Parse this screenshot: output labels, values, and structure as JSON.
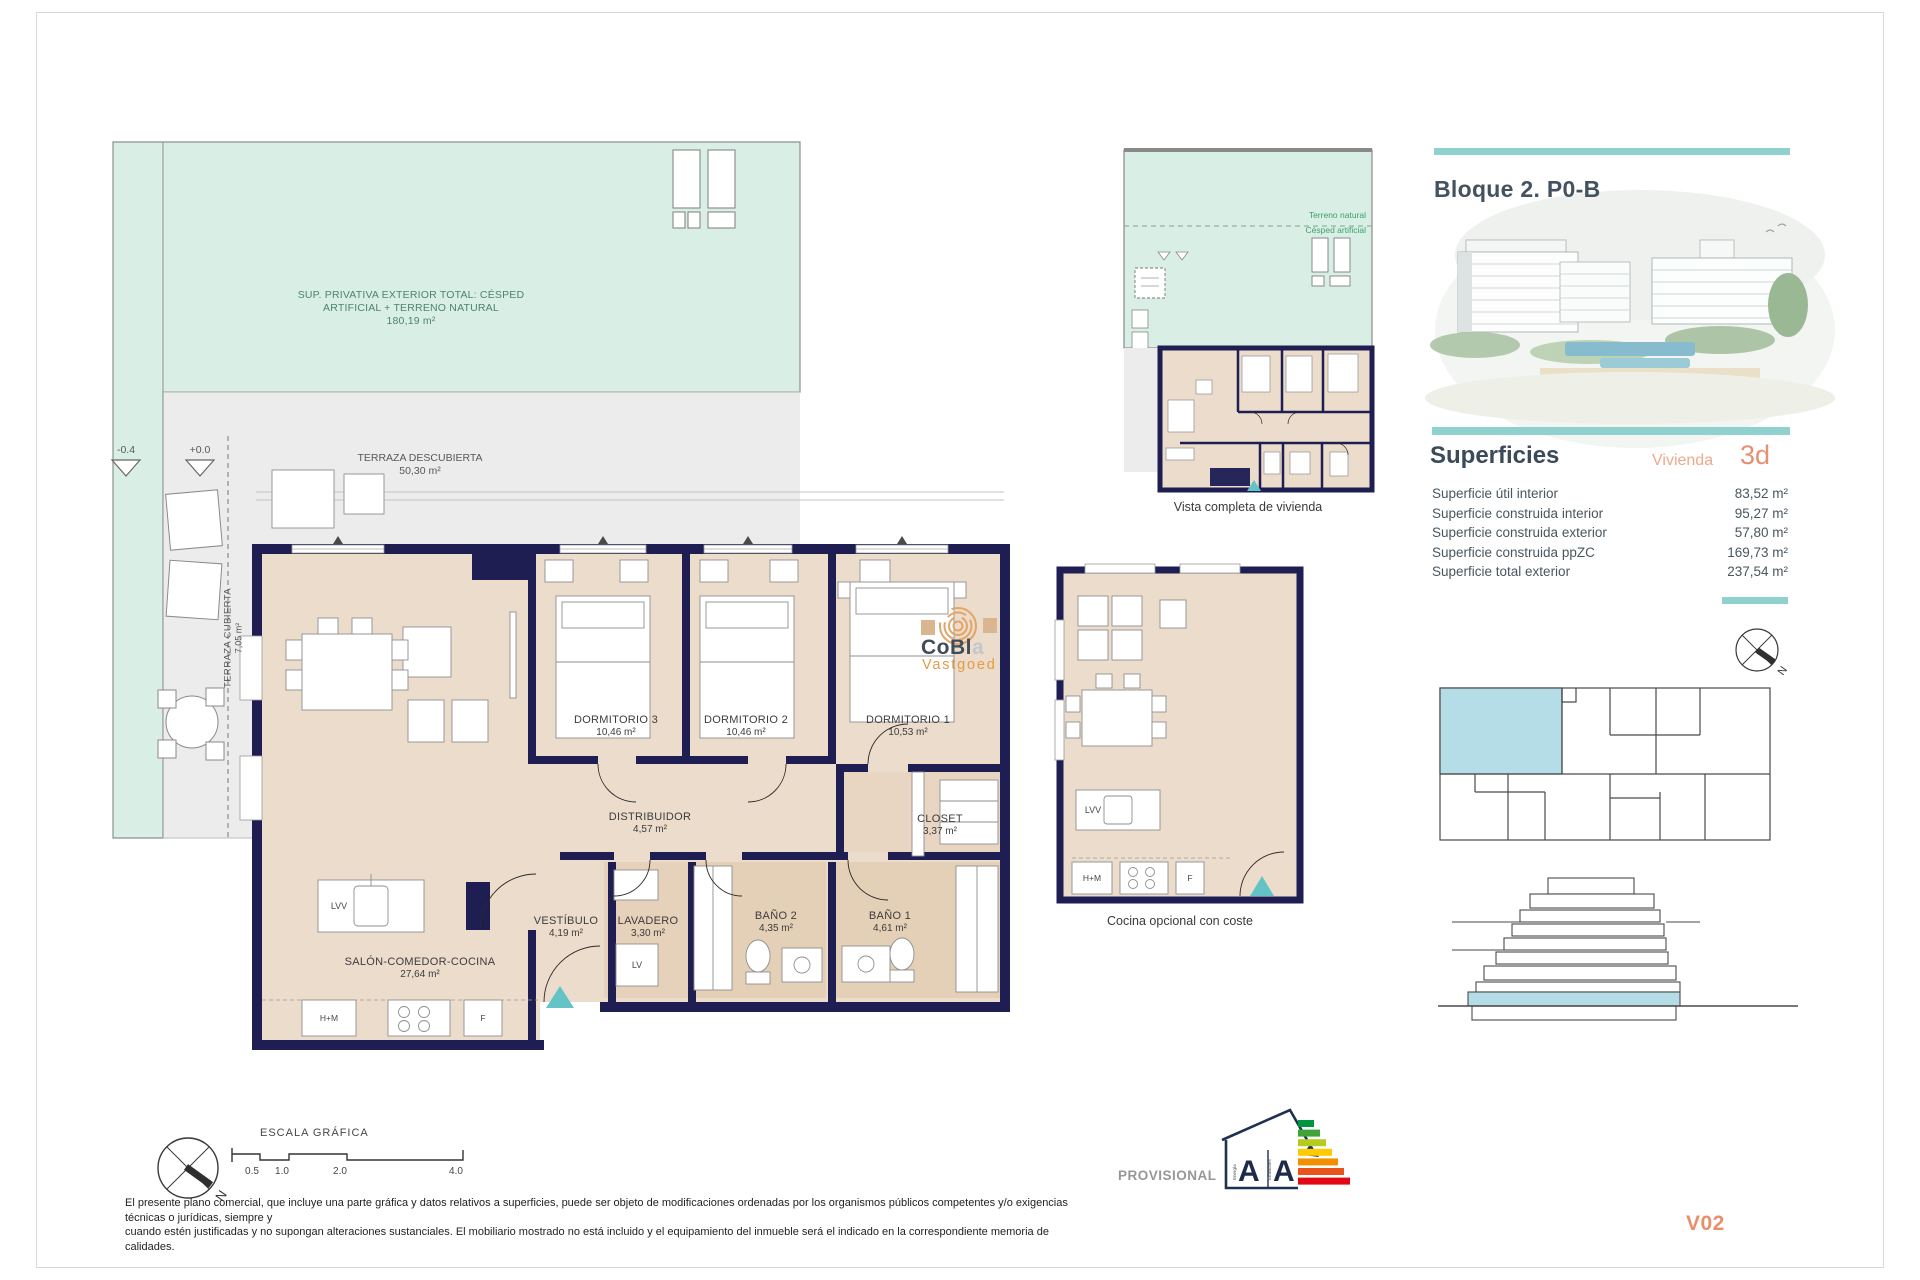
{
  "header": {
    "block_title": "Bloque 2. P0-B",
    "version": "V02",
    "provisional": "PROVISIONAL"
  },
  "superficies": {
    "title": "Superficies",
    "vivienda_label": "Vivienda",
    "vivienda_value": "3d",
    "rows": [
      {
        "label": "Superficie útil interior",
        "value": "83,52 m²"
      },
      {
        "label": "Superficie construida interior",
        "value": "95,27 m²"
      },
      {
        "label": "Superficie construida exterior",
        "value": "57,80 m²"
      },
      {
        "label": "Superficie construida ppZC",
        "value": "169,73 m²"
      },
      {
        "label": "Superficie total exterior",
        "value": "237,54 m²"
      }
    ]
  },
  "site": {
    "note_line1": "SUP. PRIVATIVA EXTERIOR TOTAL: CÉSPED",
    "note_line2": "ARTIFICIAL + TERRENO NATURAL",
    "note_area": "180,19 m²",
    "terraza_descubierta": "TERRAZA DESCUBIERTA",
    "terraza_descubierta_area": "50,30 m²",
    "terraza_cubierta": "TERRAZA CUBIERTA",
    "terraza_cubierta_area": "7,05 m²",
    "level_low": "-0.4",
    "level_zero": "+0.0"
  },
  "rooms": [
    {
      "name": "SALÓN-COMEDOR-COCINA",
      "area": "27,64 m²"
    },
    {
      "name": "DORMITORIO 3",
      "area": "10,46 m²"
    },
    {
      "name": "DORMITORIO 2",
      "area": "10,46 m²"
    },
    {
      "name": "DORMITORIO 1",
      "area": "10,53 m²"
    },
    {
      "name": "DISTRIBUIDOR",
      "area": "4,57 m²"
    },
    {
      "name": "CLOSET",
      "area": "3,37 m²"
    },
    {
      "name": "VESTÍBULO",
      "area": "4,19 m²"
    },
    {
      "name": "LAVADERO",
      "area": "3,30 m²"
    },
    {
      "name": "BAÑO 2",
      "area": "4,35 m²"
    },
    {
      "name": "BAÑO 1",
      "area": "4,61 m²"
    }
  ],
  "appliances": {
    "island": "LVV",
    "laundry": "LV",
    "oven_micro": "H+M",
    "fridge": "F"
  },
  "mini_plan": {
    "caption": "Vista completa de vivienda",
    "label_terreno": "Terreno natural",
    "label_cesped": "Césped artificial"
  },
  "kitchen_plan": {
    "caption": "Cocina opcional con coste"
  },
  "watermark": {
    "brand_main": "CoBl",
    "brand_tail": "a",
    "subtitle": "Vastgoed"
  },
  "scale_bar": {
    "title": "ESCALA GRÁFICA",
    "ticks": [
      "0.5",
      "1.0",
      "2.0",
      "4.0"
    ]
  },
  "energy": {
    "left_letter": "A",
    "right_letter": "A",
    "left_caption": "Energía",
    "right_caption": "Emisiones"
  },
  "compass": {
    "north": "N"
  },
  "disclaimer": {
    "line1": "El presente plano comercial, que incluye una parte gráfica y datos relativos a superficies, puede ser objeto de modificaciones ordenadas por los organismos públicos competentes y/o exigencias técnicas o jurídicas, siempre y",
    "line2": "cuando estén justificadas y no supongan alteraciones sustanciales. El mobiliario mostrado no está incluido y el equipamiento del inmueble será el indicado en la correspondiente memoria de calidades."
  },
  "colors": {
    "accent_teal": "#8ed1cf",
    "accent_orange": "#e78f73",
    "wall_navy": "#1e1e52",
    "mint": "#d9efe5",
    "highlight_blue": "#b5dde7"
  }
}
